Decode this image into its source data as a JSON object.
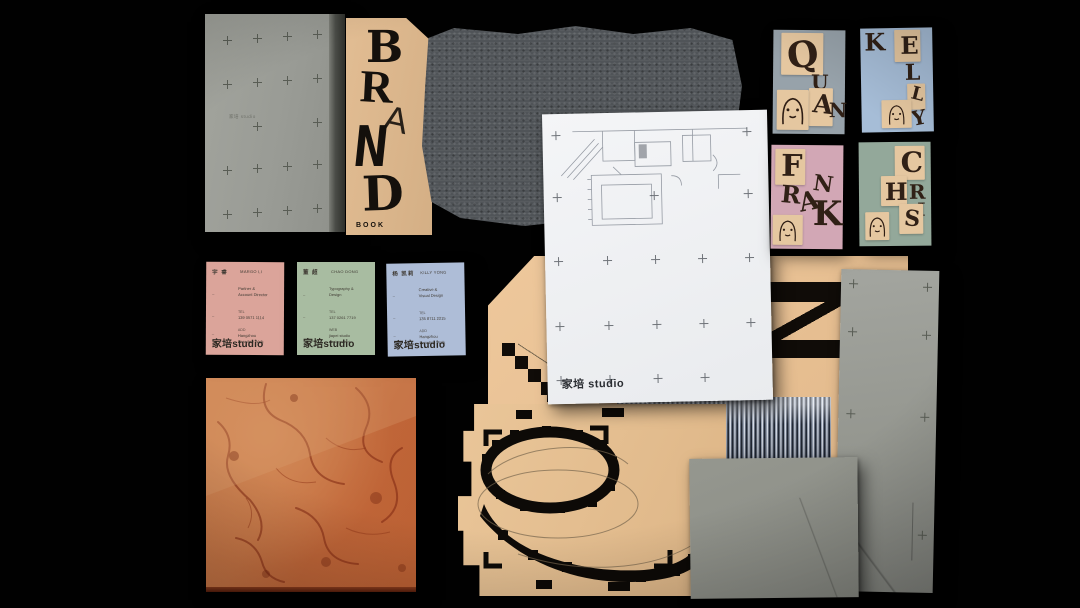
{
  "palette": {
    "background": "#000000",
    "tan": "#e7c094",
    "gray_board": "#9b9d97",
    "fabric_gray": "#505458",
    "marble_terracotta": "#bf6a3e",
    "ink_black": "#14100c",
    "card_pink": "#dba49a",
    "card_green": "#a8bca1",
    "card_blue": "#aebdd7",
    "name_quan_bg": "#97a2aa",
    "name_kelly_bg": "#a6bdd7",
    "name_frank_bg": "#d2a7b5",
    "name_chris_bg": "#93a89a"
  },
  "gray_book": {
    "cover_text": "家培 studio"
  },
  "brand_book": {
    "letters": [
      "B",
      "R",
      "A",
      "N",
      "D"
    ],
    "caption": "BOOK"
  },
  "floor_plan_sheet": {
    "logo": "家培 studio"
  },
  "name_cards": [
    {
      "name": "QUAN",
      "letters": [
        "Q",
        "U",
        "A",
        "N"
      ]
    },
    {
      "name": "KELLY",
      "letters": [
        "K",
        "E",
        "L",
        "L",
        "Y"
      ]
    },
    {
      "name": "FRANK",
      "letters": [
        "F",
        "R",
        "A",
        "N",
        "K"
      ]
    },
    {
      "name": "CHRIS",
      "letters": [
        "C",
        "H",
        "R",
        "I",
        "S"
      ]
    }
  ],
  "business_cards": [
    {
      "cn": "宇 睿",
      "en": "MARGO LI",
      "role1": "Partner &",
      "role2": "Account Director",
      "tel_label": "TEL",
      "tel": "139 0571 1114",
      "add_label": "ADD",
      "add1": "Hangzhou",
      "add2": "Paradise Walk",
      "logo": "家培studio"
    },
    {
      "cn": "董 超",
      "en": "CHAO DONG",
      "role1": "Typography &",
      "role2": "Design",
      "tel_label": "TEL",
      "tel": "137 0261 7719",
      "add_label": "WEB",
      "add1": "jiapei studio",
      "add2": "design dept.",
      "logo": "家培studio"
    },
    {
      "cn": "杨 凯莉",
      "en": "KILLY YONG",
      "role1": "Creative &",
      "role2": "Visual Design",
      "tel_label": "TEL",
      "tel": "135 8711 2215",
      "add_label": "ADD",
      "add1": "Hangzhou",
      "add2": "Paradise Walk",
      "logo": "家培studio"
    }
  ]
}
